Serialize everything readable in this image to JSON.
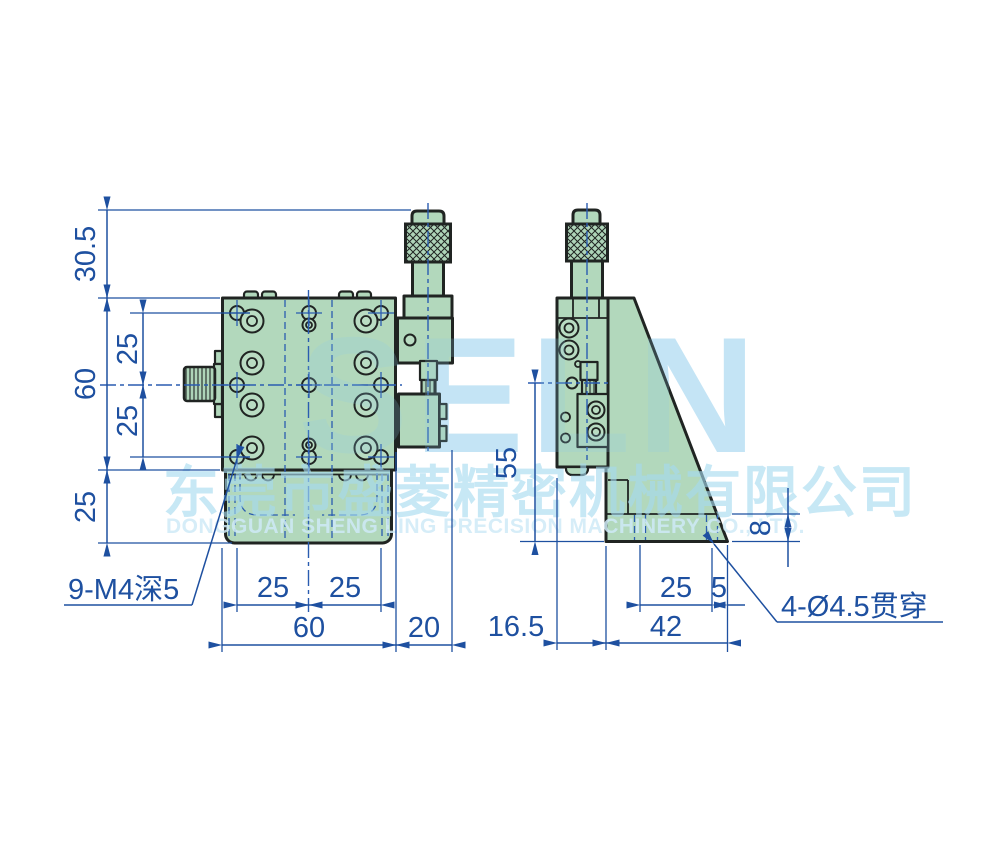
{
  "watermark": {
    "letters": "SELN",
    "company_cn": "东莞市盛菱精密机械有限公司",
    "company_en": "DONGGUAN SHENG LING PRECISION MACHINERY CO., LTD."
  },
  "front_view": {
    "dim_top_offset": "30.5",
    "dim_body_height": "60",
    "dim_hole_pitch_upper": "25",
    "dim_hole_pitch_lower": "25",
    "dim_base_height": "25",
    "dim_hole_pitch_left": "25",
    "dim_hole_pitch_right": "25",
    "dim_body_width": "60",
    "dim_bracket_width": "20",
    "hole_callout": "9-M4深5"
  },
  "side_view": {
    "dim_axis_height": "55",
    "dim_base_thickness": "8",
    "dim_hole_pitch": "25",
    "dim_hole_edge": "5",
    "dim_plate_offset": "16.5",
    "dim_base_width": "42",
    "hole_callout": "4-Ø4.5贯穿"
  },
  "colors": {
    "background": "#ffffff",
    "part_fill": "#b2d8bc",
    "outline": "#202422",
    "dimension_blue": "#1e50a0",
    "watermark_letters": "#d2ebf8",
    "watermark_text": "#a6daf0"
  }
}
